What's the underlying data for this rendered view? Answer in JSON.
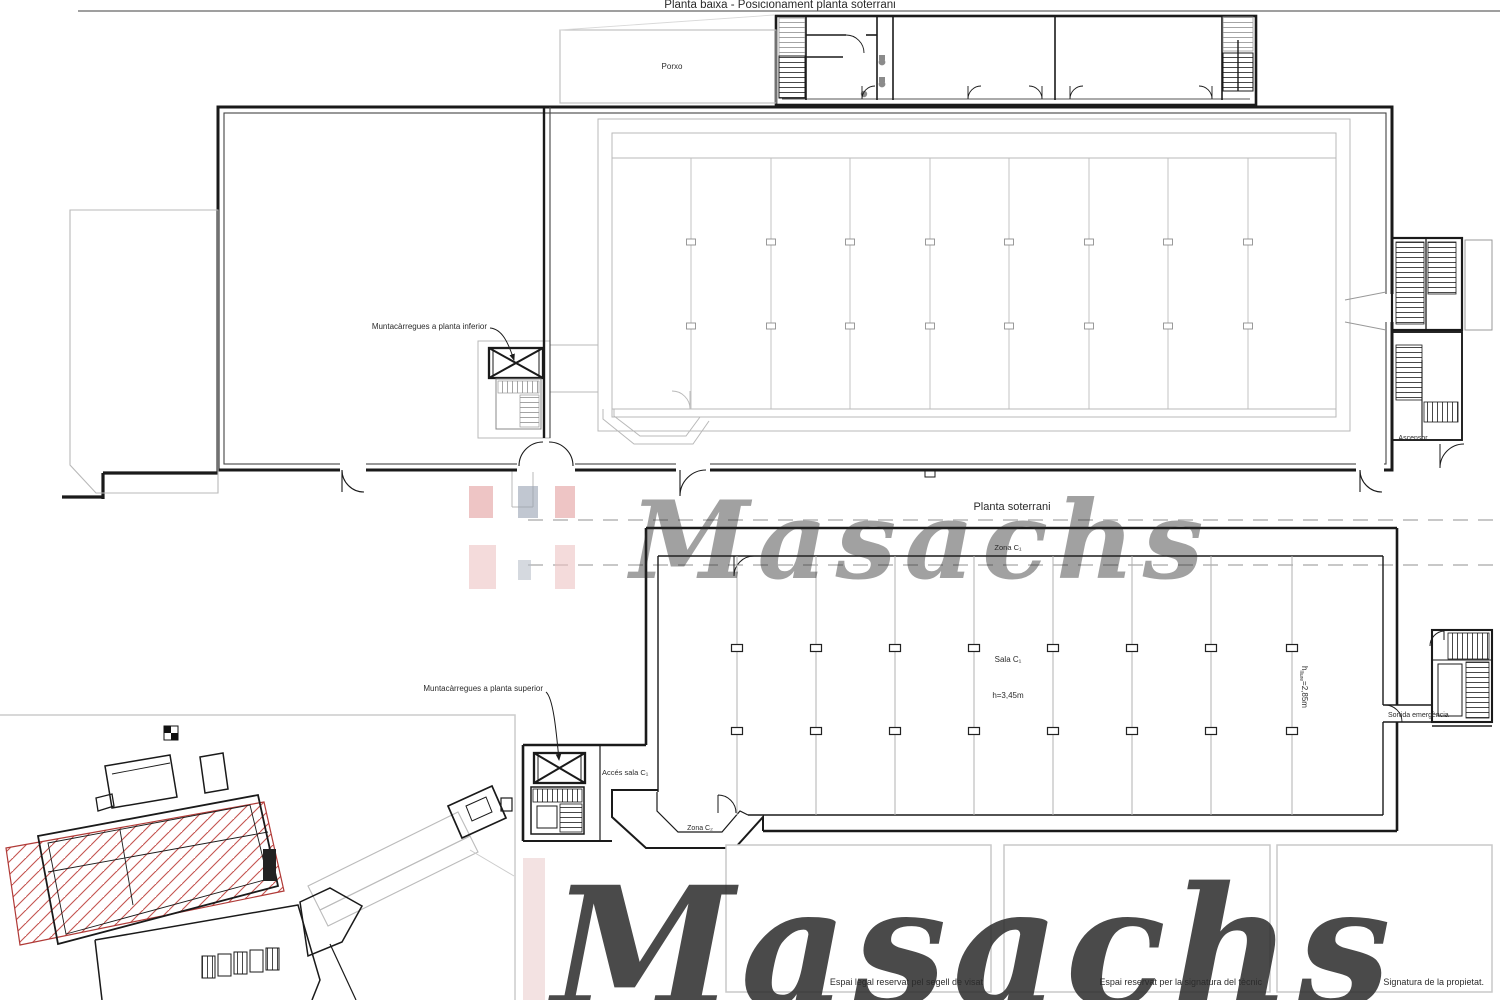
{
  "page": {
    "upper_title": "Planta baixa - Posicionament planta soterrani",
    "lower_title": "Planta soterrani"
  },
  "upper_plan": {
    "porch_label": "Porxo",
    "freight_lift_label": "Muntacàrregues a planta inferior",
    "elevator_label": "Ascensor"
  },
  "lower_plan": {
    "zone1_label": "Zona C₁",
    "hall_label": "Sala C₁",
    "hall_height_label": "h=3,45m",
    "clear_height_prefix": "h",
    "clear_height_sub": "lliure",
    "clear_height_value": "=2,85m",
    "freight_lift_label": "Muntacàrregues a planta superior",
    "access_label": "Accés sala C₁",
    "zone2_label": "Zona C₂",
    "emergency_exit_label": "Sortida emergència"
  },
  "watermark": {
    "brand": "Masachs",
    "colors": {
      "red_dark": "#e39e9e",
      "red_light": "#edc3c3",
      "gray_dark": "#99a2b2",
      "gray_light": "#b9bfca",
      "text_center": "#9aa2b0",
      "text_bottom": "#e9ebee"
    }
  },
  "footer": {
    "boxes": [
      {
        "label": "Espai legal reservat pel segell de visat"
      },
      {
        "label": "Espai reservat per la signatura del tècnic"
      },
      {
        "label": "Signatura de la propietat."
      }
    ]
  },
  "site_plan": {
    "hatch_color": "#c4524e"
  }
}
